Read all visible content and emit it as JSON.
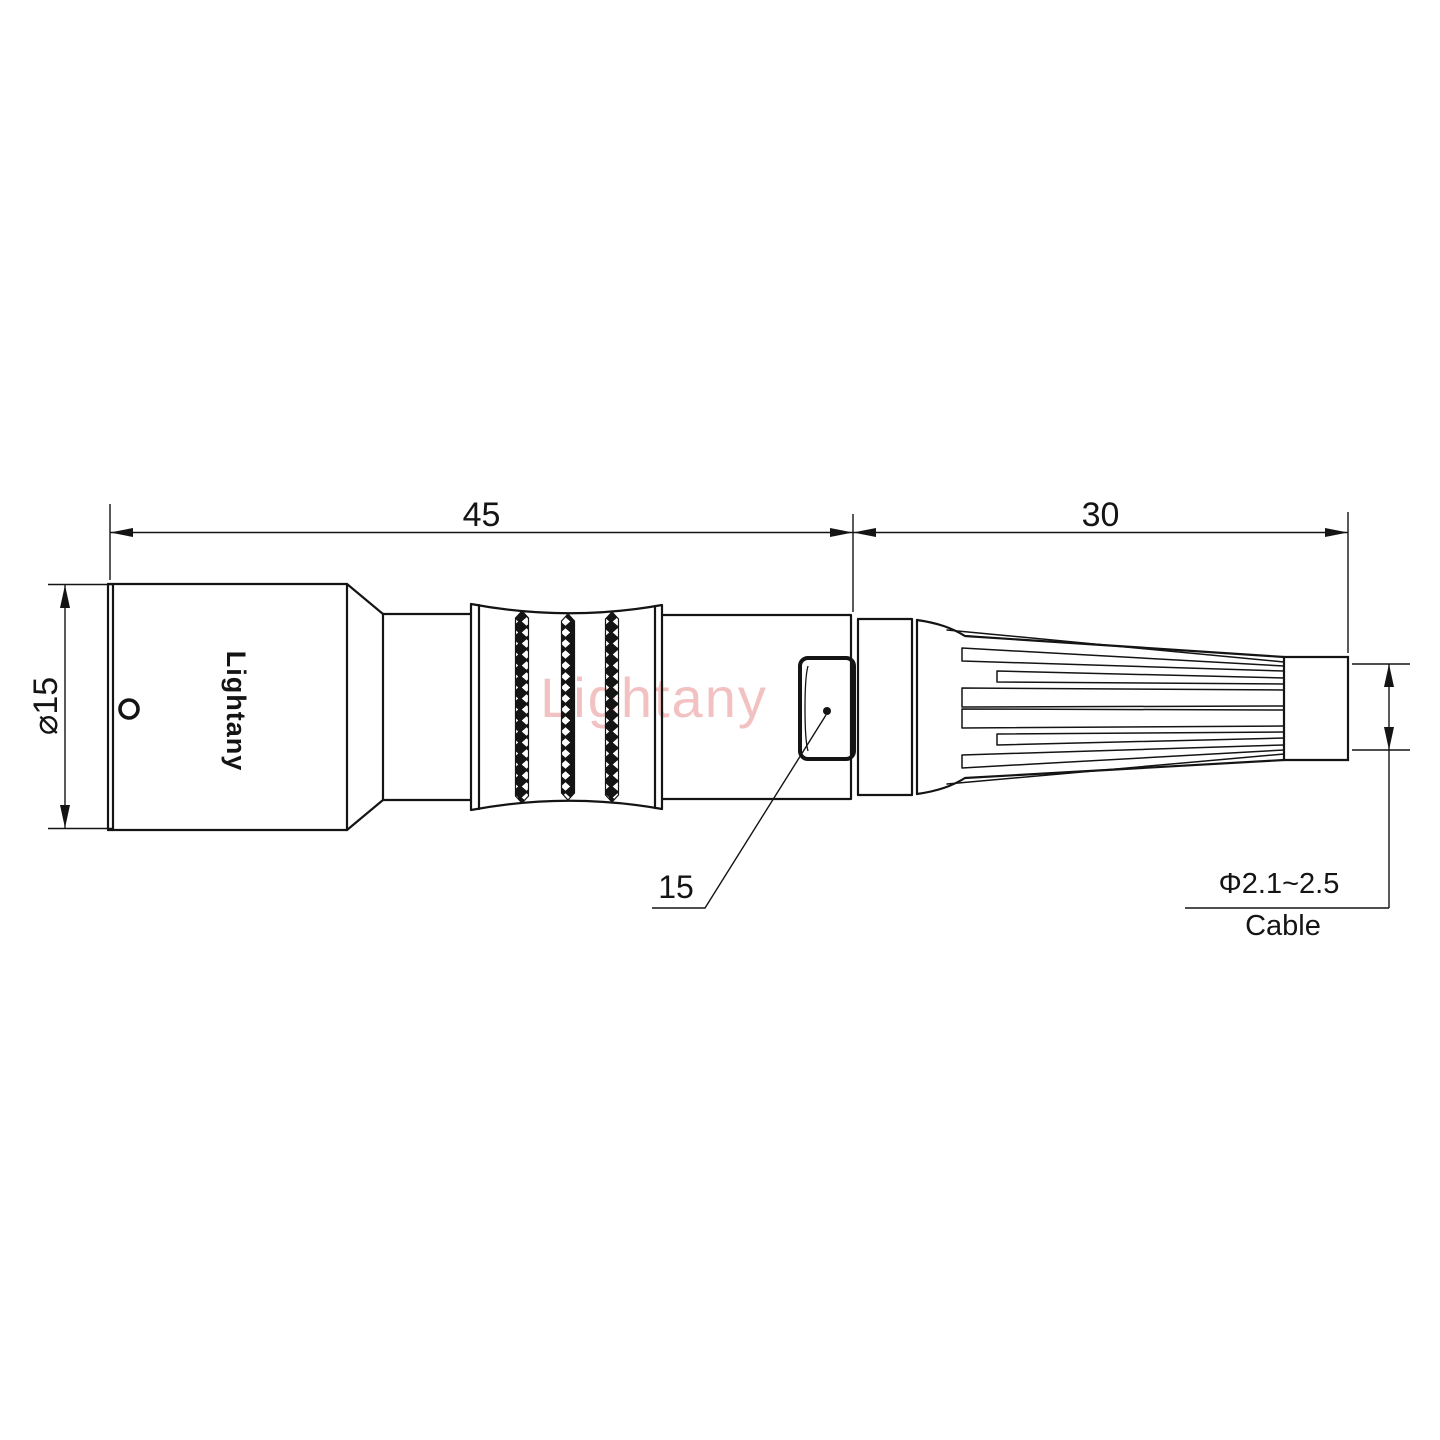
{
  "page": {
    "background": "#ffffff"
  },
  "drawing": {
    "type": "connector-technical-drawing",
    "brand_label": "Lightany",
    "watermark": "Lightany",
    "dimensions": {
      "overall_length": "45",
      "rear_length": "30",
      "body_diameter": "⌀15",
      "latch_callout": "15",
      "cable_diameter_range": "Φ2.1~2.5",
      "cable_label": "Cable"
    },
    "colors": {
      "line": "#141414",
      "watermark": "#e06c6c"
    }
  }
}
